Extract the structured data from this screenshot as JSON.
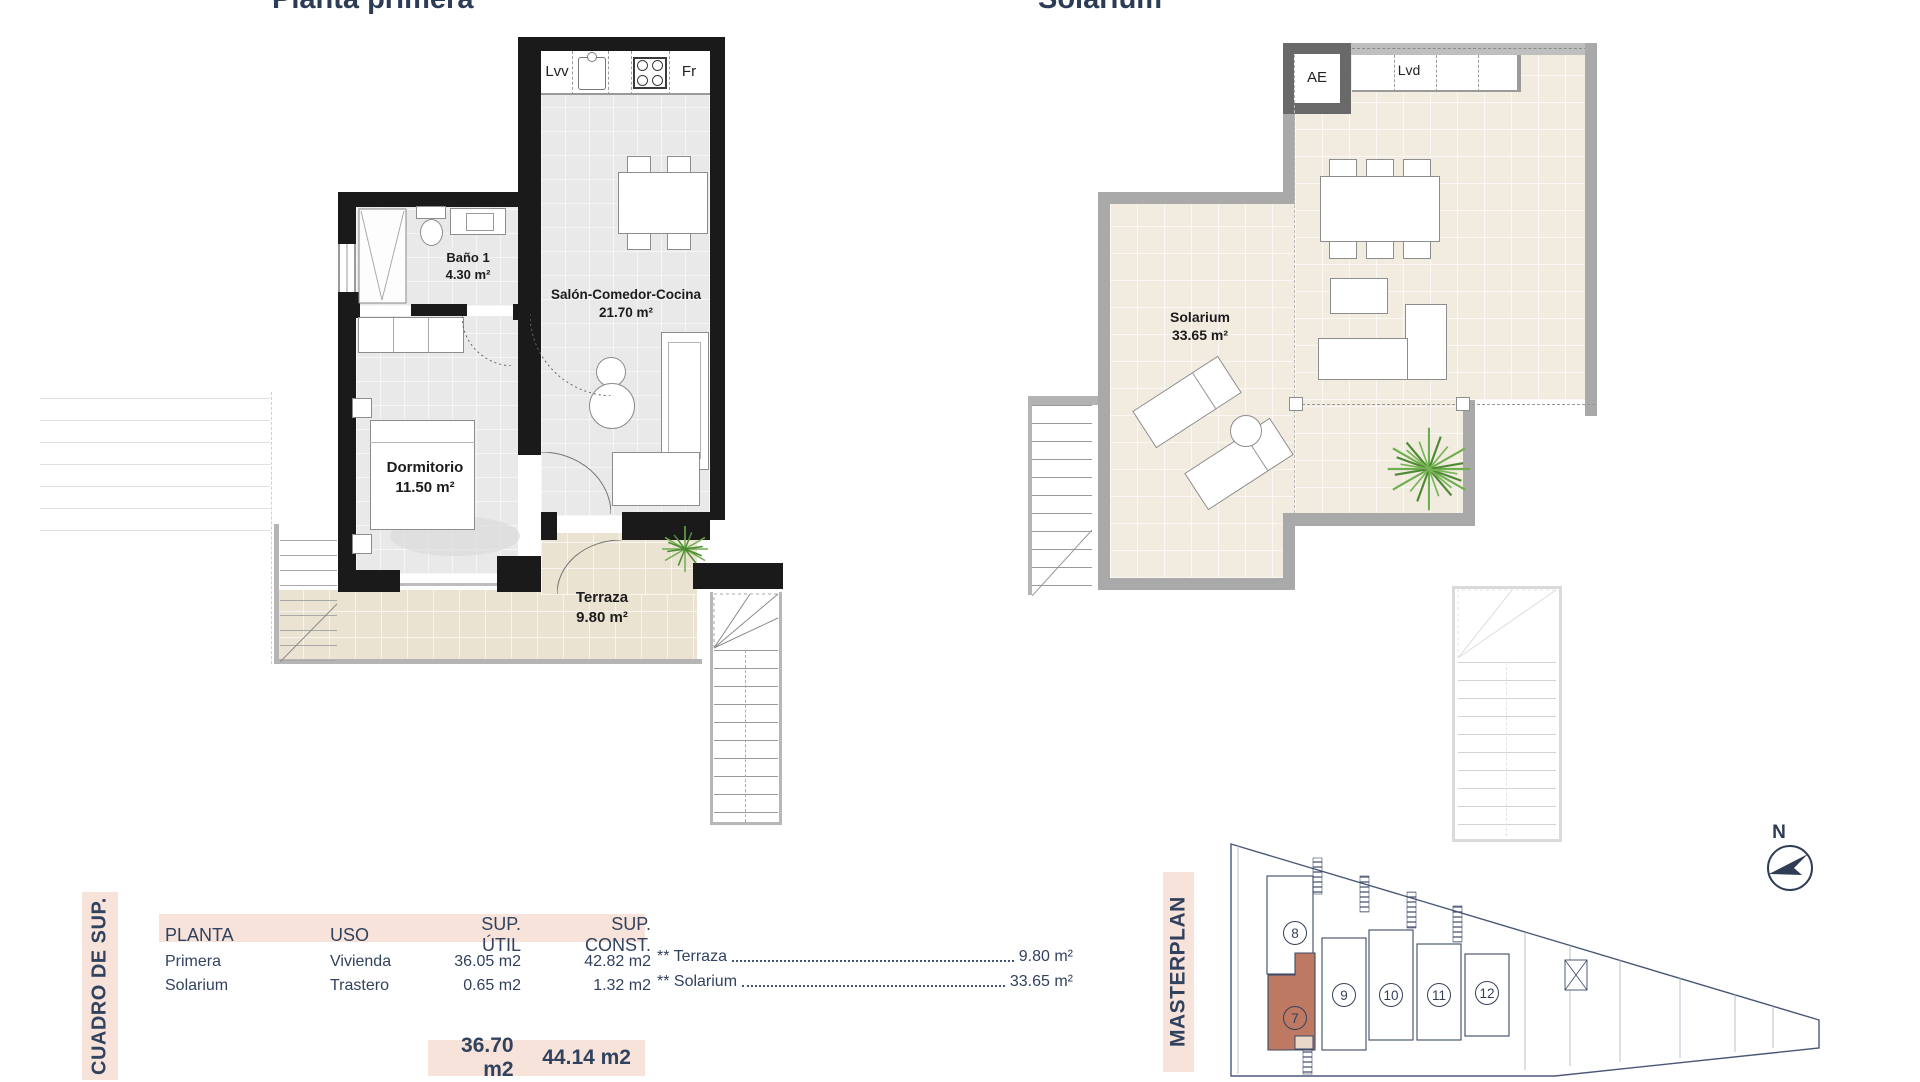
{
  "titles": {
    "left": "Planta primera",
    "right": "Solarium"
  },
  "plan1": {
    "kitchen_labels": {
      "dishwasher": "Lvv",
      "fridge": "Fr"
    },
    "bathroom": {
      "name": "Baño 1",
      "area": "4.30 m²"
    },
    "living": {
      "name": "Salón-Comedor-Cocina",
      "area": "21.70 m²"
    },
    "bedroom": {
      "name": "Dormitorio",
      "area": "11.50 m²"
    },
    "terrace": {
      "name": "Terraza",
      "area": "9.80 m²"
    }
  },
  "plan2": {
    "labels": {
      "elevator": "AE",
      "laundry": "Lvd"
    },
    "solarium": {
      "name": "Solarium",
      "area": "33.65 m²"
    }
  },
  "summary_table": {
    "side_label": "CUADRO DE SUP.",
    "headers": [
      "PLANTA",
      "USO",
      "SUP. ÚTIL",
      "SUP. CONST."
    ],
    "rows": [
      {
        "planta": "Primera",
        "uso": "Vivienda",
        "util": "36.05 m2",
        "const": "42.82 m2"
      },
      {
        "planta": "Solarium",
        "uso": "Trastero",
        "util": "0.65 m2",
        "const": "1.32 m2"
      }
    ],
    "totals": {
      "util": "36.70 m2",
      "const": "44.14 m2"
    },
    "footnotes": [
      {
        "label": "** Terraza",
        "value": "9.80 m²"
      },
      {
        "label": "** Solarium",
        "value": "33.65 m²"
      }
    ]
  },
  "masterplan": {
    "side_label": "MASTERPLAN",
    "north_label": "N",
    "highlighted_unit": "7",
    "units": [
      {
        "number": "8"
      },
      {
        "number": "7"
      },
      {
        "number": "9"
      },
      {
        "number": "10"
      },
      {
        "number": "11"
      },
      {
        "number": "12"
      }
    ]
  },
  "colors": {
    "accent_pink": "#f7e3da",
    "navy": "#31425e",
    "highlight_terracotta": "#bd7961"
  }
}
